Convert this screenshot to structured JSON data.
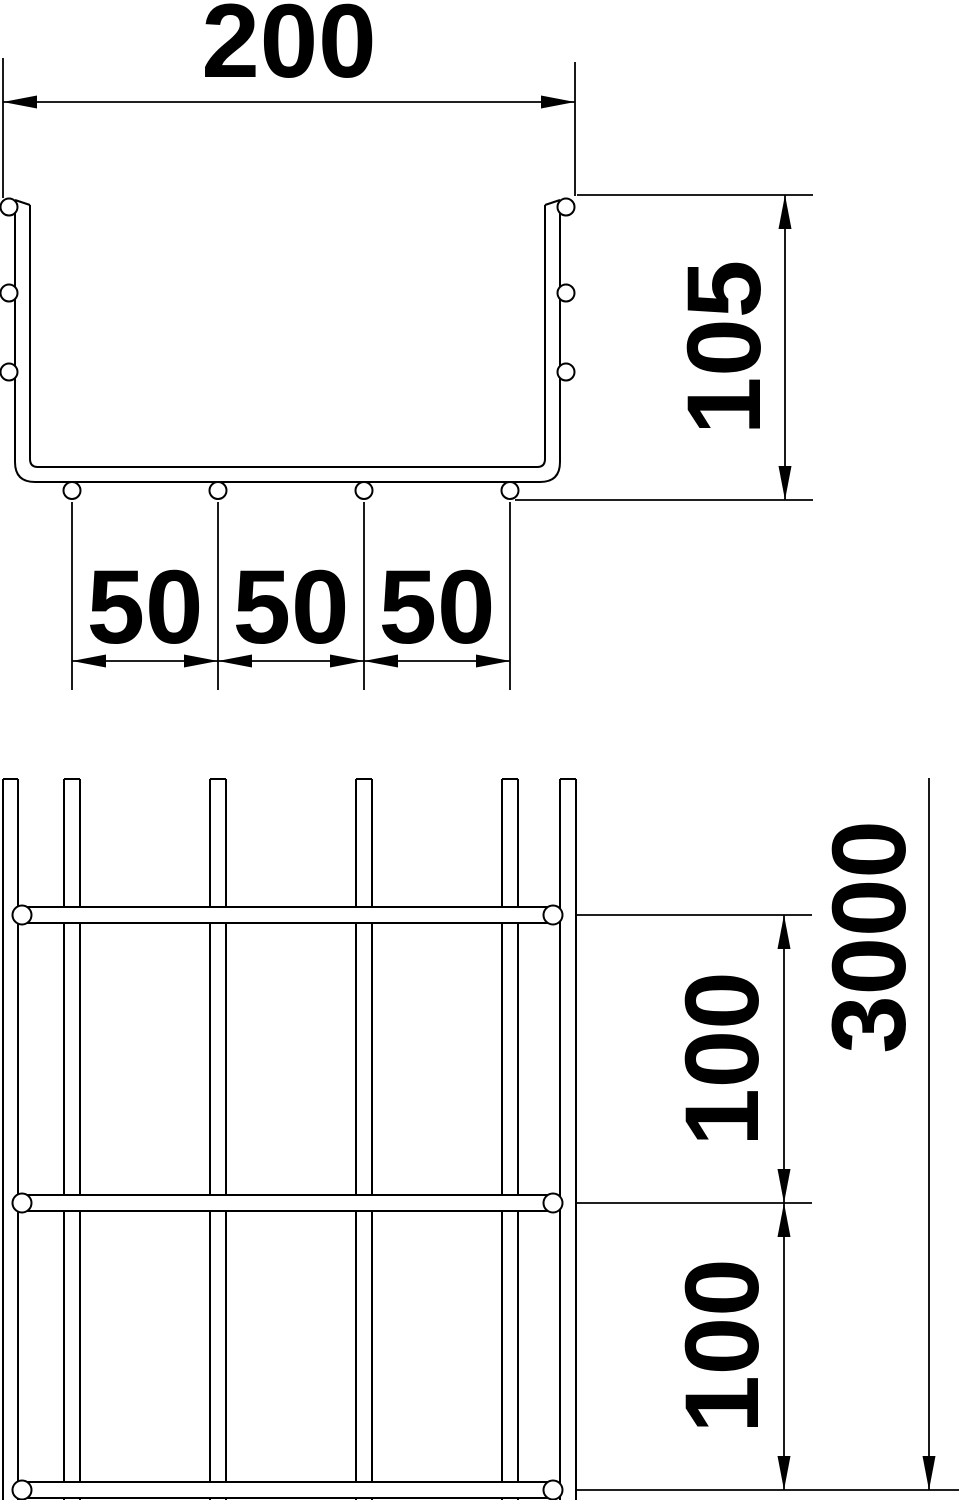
{
  "drawing": {
    "title": "Mesh cable tray - dimensional drawing",
    "background_color": "#ffffff",
    "line_color": "#000000",
    "views": {
      "cross_section": {
        "name": "cross-section-view",
        "dimensions": {
          "outer_width": "200",
          "overall_height": "105",
          "bottom_wire_spacing": [
            "50",
            "50",
            "50"
          ]
        }
      },
      "plan": {
        "name": "plan-view",
        "dimensions": {
          "mesh_pitch": [
            "100",
            "100"
          ],
          "overall_length": "3000"
        }
      }
    }
  }
}
